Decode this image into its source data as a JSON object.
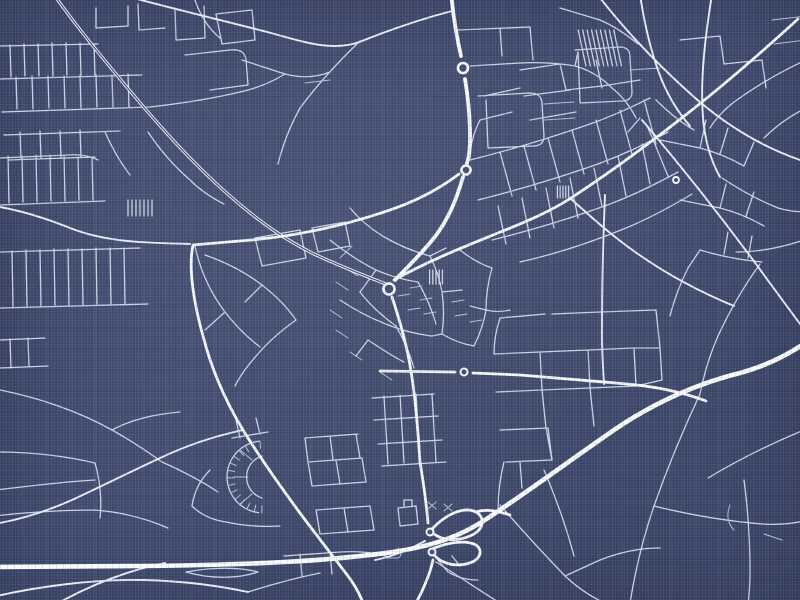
{
  "poster": {
    "kind": "blueprint-style city street map, white roads on navy linen",
    "background_color": "#3f4a6e",
    "thread_light_color": "#dfe6f4",
    "thread_dark_color": "#181f38",
    "width_px": 800,
    "height_px": 600
  },
  "map": {
    "styles": {
      "motorway": {
        "width": 4.6,
        "color": "#fbfcfe"
      },
      "trunk": {
        "width": 3.8,
        "color": "#f8fafd"
      },
      "primary": {
        "width": 2.8,
        "color": "#f4f7fb"
      },
      "secondary": {
        "width": 1.9,
        "color": "#e9eef6"
      },
      "dual": {
        "width": 3.2,
        "color": "#eff3f9",
        "core_width": 1.2,
        "core_color": "#3f4a6e"
      },
      "minor": {
        "width": 1.3,
        "color": "#cbd5e6"
      },
      "lane": {
        "width": 1.0,
        "color": "#b7c2d8"
      }
    },
    "layers": [
      {
        "class": "lane",
        "paths": [
          "M420,300 L432,298 M408,310 L420,308 M424,314 L436,312 M452,302 L464,300 M455,316 L467,314 M470,322 L482,320 M410,288 L422,286 M398,296 L410,294",
          "M345,268 L358,276 M352,246 L340,258 M336,282 L348,290 M330,310 L342,318 M336,330 L348,338 M350,352 L362,360 M380,372 L392,380",
          "M428,502 L436,509 M436,502 L428,509 M444,504 L452,511 M452,504 L444,511",
          "M398,548 C402,552 402,556 398,558 L386,558",
          "M305,83 L330,80",
          "M544,120 L575,118 M544,104 L574,102 M630,70 L660,68",
          "M772,20 L806,16 M774,44 L806,40",
          "M240,450 L252,460 M234,477 L248,477 M240,504 L252,494",
          "M730,505 C726,515 728,524 734,530",
          "M764,534 L782,540"
        ]
      },
      {
        "class": "minor",
        "paths": [
          "M0,46 L98,44 M0,79 L142,75 M2,112 L150,107",
          "M10,45 L11,77 M24,44 L25,76 M38,44 L39,76 M52,43 L53,76 M66,43 L67,75 M80,43 L81,75 M94,44 L95,75",
          "M16,77 L17,109 M32,76 L33,109 M48,76 L49,108 M64,76 L65,108 M80,75 L81,108 M96,75 L97,107 M112,75 L113,107 M128,74 L129,107",
          "M4,135 L120,131 M8,160 L95,157 M20,132 L21,158 M40,131 L41,158 M60,131 L61,157 M80,130 L81,157",
          "M96,8 L96,28 L128,26 L128,6 M138,4 L139,30 L165,28 M175,8 L176,40 L205,38 L204,6",
          "M185,55 L230,50 C240,49 245,52 246,60 L248,85 L210,90 M216,14 L252,10 L255,40 L222,44 Z",
          "M150,107 C185,103 215,98 240,92 C258,88 272,82 285,74 M242,60 L285,74 M285,74 C300,78 315,78 330,72",
          "M195,0 C200,15 208,28 220,38",
          "M0,158 L68,155 C80,154 90,156 98,160 M0,205 L105,201",
          "M8,156 L9,203 M22,156 L23,202 M36,155 L37,202 M50,155 L51,201 M64,156 L65,201 M78,157 L79,200 M92,158 L93,200",
          "M0,252 L140,248 M0,308 L148,304",
          "M12,251 L13,307 M26,250 L27,306 M40,250 L41,306 M54,249 L55,305 M68,249 L69,305 M82,249 L83,305 M96,248 L97,304 M110,248 L111,304 M124,248 L125,304",
          "M0,340 L45,338 M10,339 L11,368 M28,338 L29,367 M0,368 L48,366",
          "M0,390 C40,398 80,412 112,430 C130,440 148,452 162,462",
          "M-4,452 C30,452 65,456 95,463 M95,463 C100,480 102,500 100,518",
          "M-4,490 C30,486 60,482 95,480",
          "M112,430 C130,420 155,414 180,412 M162,462 C180,470 200,480 218,492",
          "M-6,516 C30,512 62,510 95,510 M95,510 C120,512 145,518 168,528",
          "M205,255 C225,262 245,272 262,285 C275,295 287,307 296,320 M296,320 C282,330 268,342 257,355 C248,365 240,376 235,386",
          "M195,246 C200,270 210,292 225,312 C235,325 247,337 260,347 M225,312 L205,330 M262,285 L245,302",
          "M255,238 L300,230 L306,258 L262,266 Z M312,228 L345,222 L350,246 L318,252 Z",
          "M148,132 C160,150 174,166 190,180 M190,180 C200,190 212,198 224,204 M105,132 C112,148 120,162 130,175",
          "M350,208 C360,220 372,230 386,238 M386,238 C400,246 415,252 430,256",
          "M330,240 C345,252 360,262 376,270 M376,270 L360,292 M376,270 C390,276 404,280 418,282",
          "M340,300 C355,310 370,318 386,324 M386,324 C400,330 416,334 432,336",
          "M360,292 C370,305 382,316 396,326 M418,282 C426,296 432,310 436,324",
          "M430,256 L446,248 M430,256 C436,268 440,280 442,292 M442,292 L462,290 M442,292 C444,306 444,320 442,334",
          "M432,336 L442,334 M442,334 C452,340 462,344 474,346 M474,346 C480,334 484,322 486,310 M486,310 L470,306 M486,310 C494,312 502,312 510,310",
          "M460,250 C470,258 480,264 492,268 M492,268 C488,282 486,296 486,310",
          "M396,326 C404,340 410,354 414,368 M368,340 C380,348 392,356 404,362 M368,340 L356,356",
          "M470,160 C510,150 550,138 590,124 C610,117 630,108 650,98",
          "M478,200 C518,190 558,178 598,164 C622,155 646,144 668,132",
          "M492,240 C532,230 572,218 610,204 C634,195 656,184 678,172",
          "M520,262 C556,254 592,242 626,228 C650,218 672,206 692,194",
          "M500,152 L512,196 M524,146 L536,190 M548,138 L560,182 M572,130 L584,174 M596,120 L608,164 M620,110 L632,154 M644,100 L656,144",
          "M506,244 L498,206 M530,238 L522,198 M554,228 L546,188 M578,218 L570,178 M602,206 L594,168 M626,196 L618,156 M650,184 L642,144",
          "M520,70 L560,64 M524,96 L570,90 M530,120 L576,112 M560,64 L566,90 M596,60 L602,88 M566,90 L602,86 M602,86 L640,80",
          "M480,120 L512,112 M484,96 L520,88 M480,120 C474,132 470,144 470,158",
          "M660,140 L700,148 C715,152 730,158 744,166 M700,148 L706,120 M720,154 L728,128 M744,166 L754,142",
          "M680,200 L720,208 C736,212 750,218 764,226 M720,208 L726,184 M746,216 L754,192",
          "M700,250 C720,256 740,260 762,262 M724,254 L728,232 M748,258 L752,236",
          "M500,318 L545,314 M552,314 L600,312 M500,318 C496,330 494,342 494,354",
          "M494,354 L540,352 L588,350 L634,348 M496,392 L542,390 L590,388 L636,386",
          "M500,430 L548,428 M506,462 L552,460 M548,428 L552,460",
          "M540,352 L542,390 M588,350 L590,388 M634,348 L636,386 M542,390 L546,428 M590,388 L594,426 M546,428 L552,460",
          "M656,310 L660,348 L662,380 M600,312 L656,310 M634,348 L660,348 M636,386 L662,380",
          "M504,462 C500,478 498,494 498,510 M520,462 L522,488",
          "M305,438 L358,434 M308,462 L362,458 M312,486 L366,482 M305,438 L308,462 M330,436 L333,460 M356,434 L360,458 M308,462 L312,486 M336,460 L340,484 M362,458 L366,482",
          "M316,510 L370,506 M320,534 L374,530 M316,510 L320,534 M344,508 L348,532 M370,506 L374,530",
          "M284,556 L340,552 C356,551 372,552 386,556 M300,554 L302,576 M330,552 L332,574",
          "M232,438 L268,432 M236,420 L240,438 M256,418 L260,434",
          "M210,470 C200,480 194,492 192,506 M192,506 C200,514 212,520 226,522 M226,522 C244,526 262,527 280,526",
          "M186,572 C212,567 240,567 258,572 C238,579 210,579 186,572",
          "M248,592 C270,585 295,578 320,573",
          "M262,456 A22,22 0 0,0 262,498",
          "M372,398 L434,394 M374,420 L438,416 M378,444 L442,440 M382,466 L446,462",
          "M384,396 L388,464 M400,395 L404,463 M416,394 L420,462 M432,394 L436,462",
          "M398,508 L416,506 L418,524 L400,526 Z M404,506 L404,500 L412,500 L412,506",
          "M438,560 L448,572 M448,572 C458,578 468,580 478,580 M452,556 L460,566",
          "M436,562 C460,577 482,592 500,603",
          "M500,505 C520,528 542,552 565,576 C580,590 596,600 612,606",
          "M700,394 C684,428 668,466 654,506 C644,535 636,566 630,603",
          "M654,506 C690,515 726,521 762,524 C776,525 790,524 804,521",
          "M565,576 L600,560 M600,560 C620,552 640,548 660,548",
          "M544,470 C556,498 566,526 574,556",
          "M804,430 C770,444 738,460 708,478",
          "M760,264 C744,286 730,310 718,336 C710,354 704,374 700,394",
          "M744,480 C748,510 750,540 750,572 C750,584 749,596 748,606",
          "M648,128 C656,146 662,162 668,176",
          "M640,118 L628,132 M656,100 C668,112 680,122 694,130",
          "M722,178 C740,190 758,200 778,208 M778,208 C788,211 798,212 808,212",
          "M688,268 C680,284 674,300 670,316 M700,250 L688,268",
          "M804,240 C780,248 758,252 736,252",
          "M806,60 C780,72 756,86 734,102 M734,102 C724,110 716,118 710,128",
          "M806,108 C790,116 776,126 764,138",
          "M360,41 C338,62 318,84 300,108 M300,108 C290,126 283,144 278,164",
          "M458,30 L530,27 M530,27 L533,60 M500,28 L502,56",
          "M478,96 L530,93 C538,93 542,97 542,104 L544,136 C544,143 540,146 533,146 L488,148 M488,148 L486,100",
          "M575,50 L620,47 C627,47 630,51 630,57 L632,92 C632,98 628,101 622,101 L580,103 L578,52",
          "M470,66 L520,63 C540,62 558,63 575,66 M575,66 L578,52 M575,66 C590,70 602,78 612,88 M612,88 C622,96 630,106 636,118",
          "M680,40 L720,36 M720,36 L724,64 M724,64 L762,60 M762,60 L766,88",
          "M560,8 L600,20 M600,20 C614,26 626,34 638,44"
        ]
      },
      {
        "class": "secondary",
        "paths": [
          "M597,-6 C624,29 657,64 694,97 C734,132 772,151 806,162",
          "M640,-6 C644,22 650,48 659,73 C666,92 676,110 690,126",
          "M712,-6 C705,38 700,80 703,118 C705,140 711,161 720,177",
          "M642,120 C676,160 716,210 756,264 C772,286 789,309 803,328",
          "M605,195 C603,240 602,290 602,335 C602,352 603,368 604,384",
          "M-8,597 C40,586 95,579 145,580 C180,581 215,585 248,592",
          "M60,602 C95,583 130,570 165,563",
          "M-6,206 C20,210 45,218 70,228 C105,242 145,243 190,244",
          "M375,560 C395,556 410,549 425,541",
          "M243,430 C215,436 185,446 158,459 C130,472 100,487 72,500 C45,512 18,520 -6,524",
          "M570,198 C590,216 612,236 638,254 C668,275 700,292 734,306",
          "M452,11 C421,19 392,29 362,41 C333,53 301,41 271,33 C221,20 170,8 126,-4"
        ]
      },
      {
        "class": "dual",
        "paths": [
          "M52,-8 C76,26 104,60 136,98 C168,136 200,170 230,196 C262,224 286,240 314,254 C342,267 368,277 386,284"
        ]
      },
      {
        "class": "primary",
        "paths": [
          "M459,174 C434,193 409,204 384,212 C339,227 294,236 251,240 L193,245 C188,268 194,304 203,336 C212,371 226,402 243,430 C259,456 278,483 297,509 C314,532 332,555 348,576 C354,584 359,592 363,603",
          "M394,280 C430,260 466,246 498,233 C528,221 551,211 571,198 C606,175 646,146 683,117 C723,86 763,51 798,19",
          "M392,297 C400,321 407,346 411,371 C415,396 418,430 420,462 C423,481 426,498 428,523",
          "M433,560 C430,574 424,588 416,603",
          "M380,371 L455,372 M473,373 L520,375 C558,378 592,381 627,384 C660,387 685,393 706,401",
          "M432,529 C446,514 464,506 476,512 C486,518 484,530 470,536 C456,542 442,540 434,534 M476,512 C488,508 500,512 510,515",
          "M434,548 C450,542 466,540 476,545 C484,551 480,561 466,564 C452,567 440,562 434,555"
        ]
      },
      {
        "class": "trunk",
        "paths": [
          "M451,-8 C453,14 456,34 461,56",
          "M465,79 C468,97 470,114 470,136 C470,149 469,158 467,163",
          "M463,177 C456,201 448,220 434,238 C420,255 404,271 395,280"
        ]
      },
      {
        "class": "motorway",
        "paths": [
          "M-10,567 L140,566 C250,565 330,561 393,552 C432,546 460,537 488,518 C530,490 572,459 614,430 C658,400 700,383 740,373 C766,366 788,355 808,341"
        ]
      }
    ],
    "roundabouts": [
      {
        "cx": 463,
        "cy": 68,
        "r": 5.0
      },
      {
        "cx": 466,
        "cy": 170,
        "r": 4.5
      },
      {
        "cx": 389,
        "cy": 289,
        "r": 5.5
      },
      {
        "cx": 464,
        "cy": 372,
        "r": 3.5
      },
      {
        "cx": 430,
        "cy": 532,
        "r": 3.5
      },
      {
        "cx": 432,
        "cy": 552,
        "r": 3.5
      },
      {
        "cx": 676,
        "cy": 180,
        "r": 3.0
      }
    ],
    "hatches": [
      {
        "x": 576,
        "y": 30,
        "w": 40,
        "h": 36,
        "tilt": 12,
        "count": 9
      },
      {
        "x": 126,
        "y": 200,
        "w": 28,
        "h": 16,
        "tilt": 0,
        "count": 7
      },
      {
        "x": 428,
        "y": 270,
        "w": 16,
        "h": 14,
        "tilt": 0,
        "count": 5
      },
      {
        "x": 556,
        "y": 186,
        "w": 14,
        "h": 12,
        "tilt": 0,
        "count": 5
      }
    ],
    "crescent": {
      "cx": 263,
      "cy": 477,
      "r": 36,
      "a1": 95,
      "a2": 268,
      "ticks": 14,
      "tick_len": 7
    }
  }
}
